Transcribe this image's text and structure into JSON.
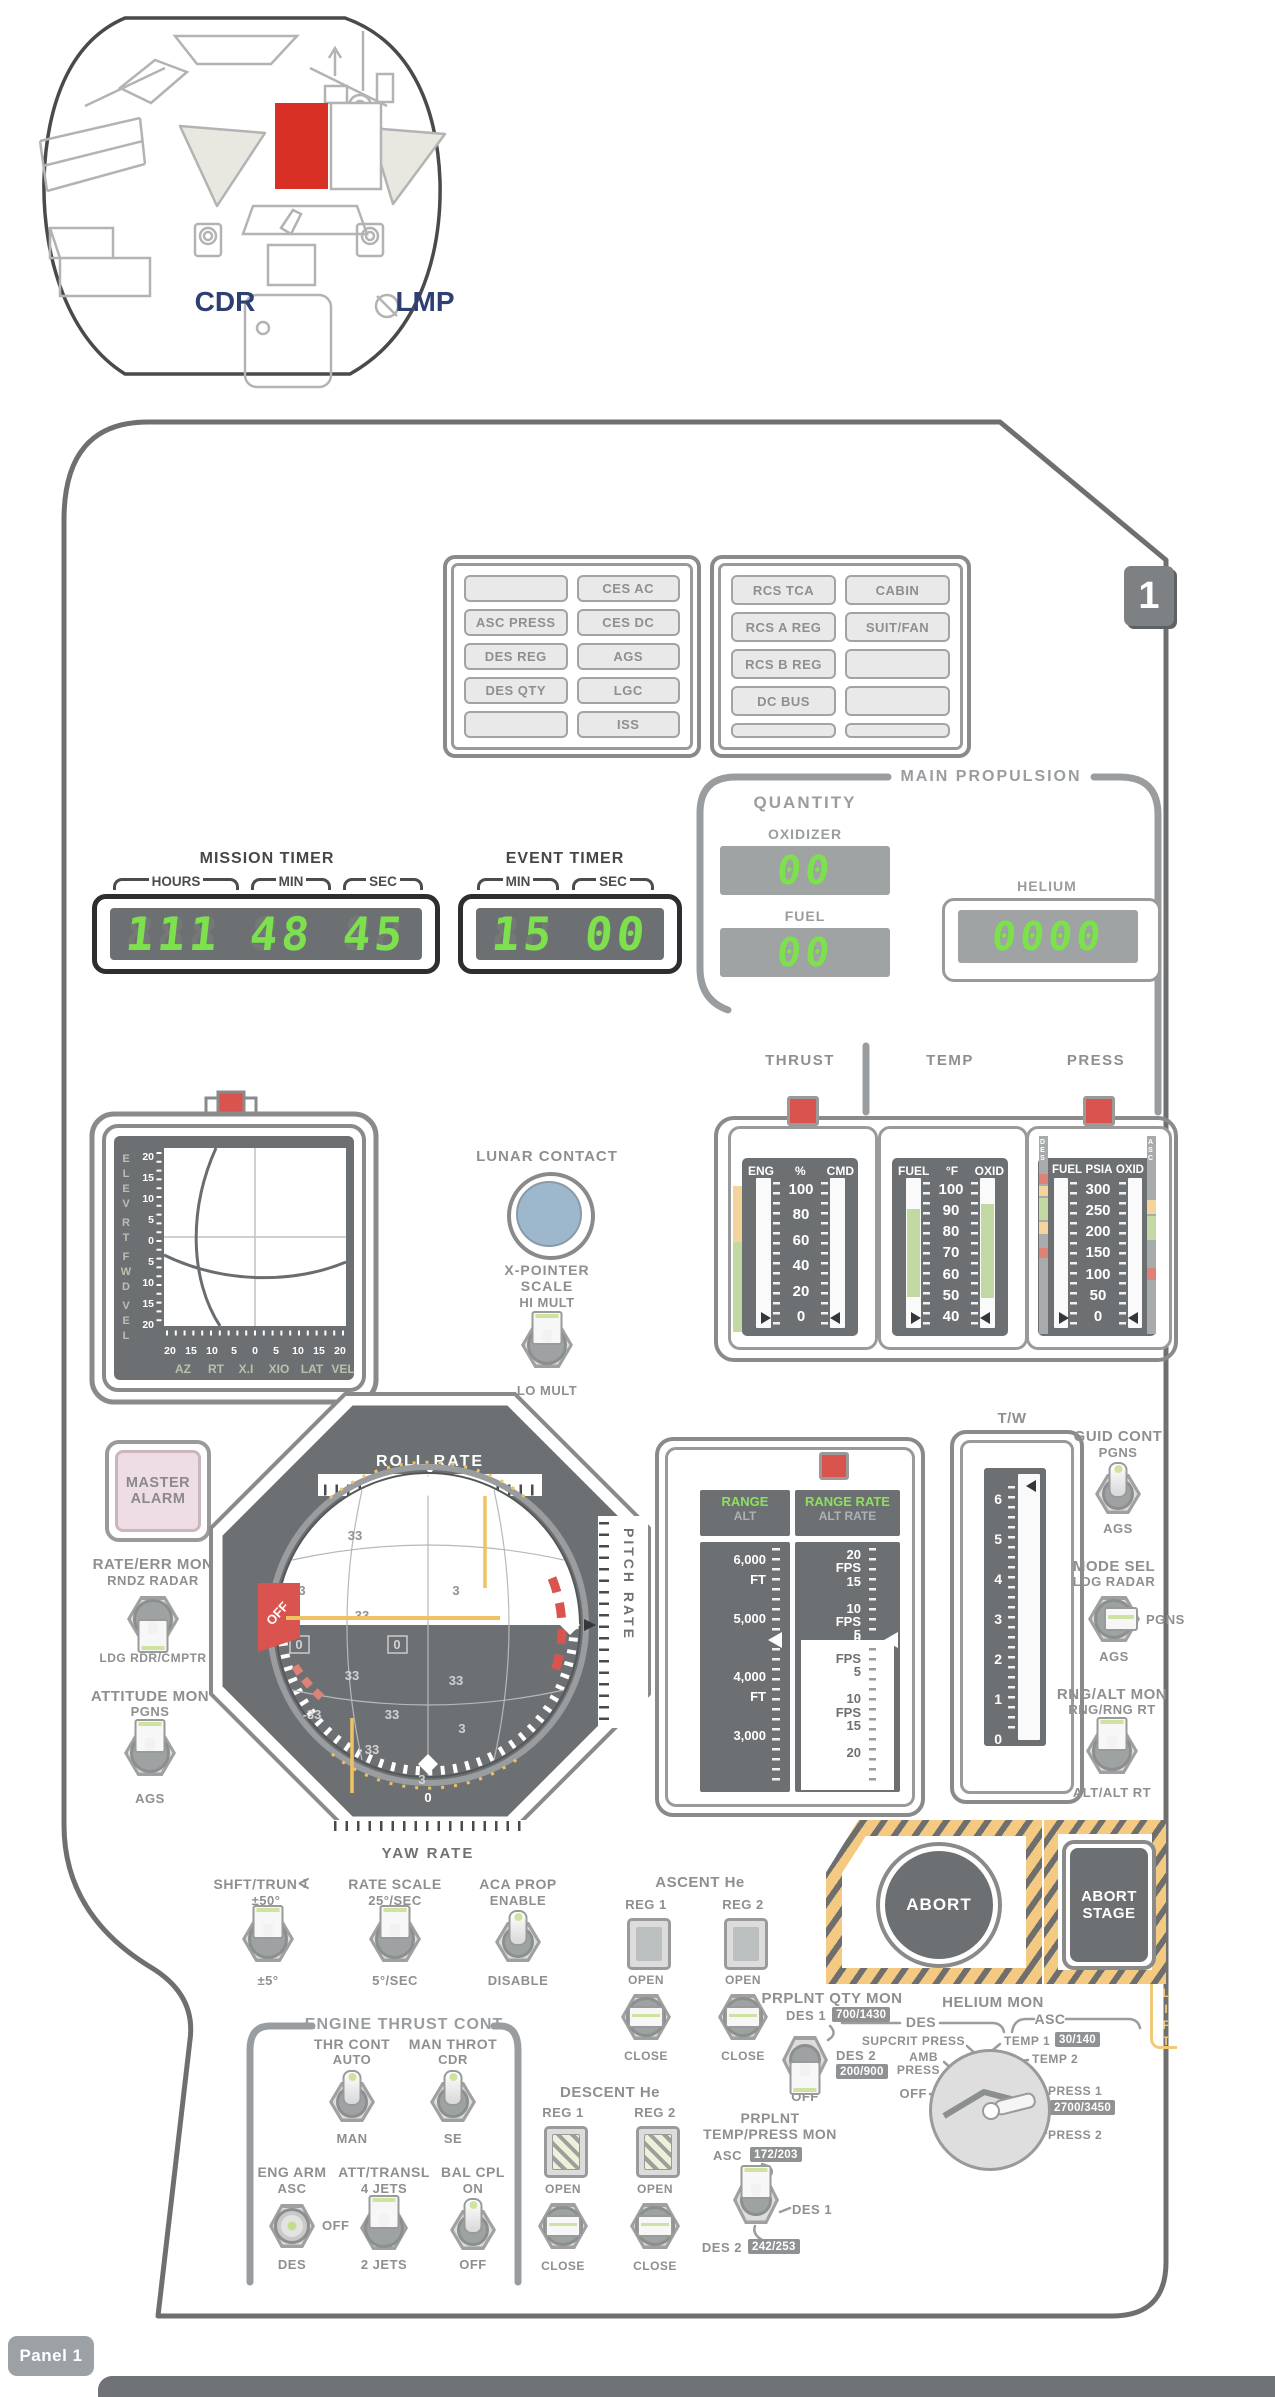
{
  "cabin": {
    "cdr": "CDR",
    "lmp": "LMP"
  },
  "panel_badge": "1",
  "cw_left": {
    "lights": [
      "",
      "CES AC",
      "ASC PRESS",
      "CES DC",
      "DES REG",
      "AGS",
      "DES QTY",
      "LGC",
      "",
      "ISS"
    ]
  },
  "cw_right": {
    "lights": [
      "RCS TCA",
      "CABIN",
      "RCS A REG",
      "SUIT/FAN",
      "RCS B REG",
      "",
      "DC BUS",
      "",
      "",
      ""
    ]
  },
  "mission_timer": {
    "title": "MISSION TIMER",
    "brackets": [
      "HOURS",
      "MIN",
      "SEC"
    ],
    "hours": "111",
    "min": "48",
    "sec": "45",
    "ghost3": "888",
    "ghost2": "88"
  },
  "event_timer": {
    "title": "EVENT TIMER",
    "brackets": [
      "MIN",
      "SEC"
    ],
    "min": "15",
    "sec": "00",
    "ghost2": "88"
  },
  "main_propulsion": {
    "title": "MAIN PROPULSION",
    "quantity": "QUANTITY",
    "oxidizer_label": "OXIDIZER",
    "oxidizer": "00",
    "fuel_label": "FUEL",
    "fuel": "00",
    "helium_label": "HELIUM",
    "helium": "0000",
    "ghost2": "88",
    "ghost4": "8888"
  },
  "thrust_gauge": {
    "title": "THRUST",
    "col_left": "ENG",
    "col_mid": "%",
    "col_right": "CMD",
    "scale": [
      "100",
      "80",
      "60",
      "40",
      "20",
      "0"
    ]
  },
  "temp_gauge": {
    "title": "TEMP",
    "col_left": "FUEL",
    "col_mid": "°F",
    "col_right": "OXID",
    "scale": [
      "100",
      "90",
      "80",
      "70",
      "60",
      "50",
      "40"
    ]
  },
  "press_gauge": {
    "title": "PRESS",
    "col_left": "FUEL",
    "col_mid": "PSIA",
    "col_right": "OXID",
    "scale": [
      "300",
      "250",
      "200",
      "150",
      "100",
      "50",
      "0"
    ],
    "left_strip": "DES",
    "right_strip": "ASC"
  },
  "xpointer": {
    "left_letters": [
      "E",
      "L",
      "E",
      "V",
      "R",
      "T",
      "F",
      "W",
      "D",
      "V",
      "E",
      "L"
    ],
    "v_scale": [
      "20",
      "15",
      "10",
      "5",
      "0",
      "5",
      "10",
      "15",
      "20"
    ],
    "h_scale": [
      "20",
      "15",
      "10",
      "5",
      "0",
      "5",
      "10",
      "15",
      "20"
    ],
    "bottom_labels": [
      "AZ",
      "RT",
      "X.I",
      "XIO",
      "LAT",
      "VEL"
    ]
  },
  "lunar_contact": {
    "label": "LUNAR CONTACT"
  },
  "xpointer_scale": {
    "title1": "X-POINTER",
    "title2": "SCALE",
    "up": "HI MULT",
    "down": "LO MULT"
  },
  "master_alarm": {
    "line1": "MASTER",
    "line2": "ALARM"
  },
  "rate_err_mon": {
    "title": "RATE/ERR MON",
    "up": "RNDZ RADAR",
    "down": "LDG RDR/CMPTR"
  },
  "attitude_mon": {
    "title": "ATTITUDE MON",
    "up": "PGNS",
    "down": "AGS"
  },
  "fdai": {
    "roll": "ROLL RATE",
    "pitch": "PITCH RATE",
    "yaw": "YAW RATE",
    "zero_top": "0",
    "zero_bottom": "0",
    "zero_pitch": "0",
    "off_flag": "OFF",
    "ball_numbers": [
      "33",
      "3",
      "3",
      "33",
      "0",
      "0",
      "33",
      "33",
      "-33",
      "33",
      "3",
      "33",
      "3"
    ]
  },
  "range_tapes": {
    "range": "RANGE",
    "alt": "ALT",
    "range_rate": "RANGE RATE",
    "alt_rate": "ALT RATE",
    "left_text": "6,000\nFT\n\n5,000\n\n\n4,000\nFT\n\n3,000",
    "right_top_text": "20\nFPS\n15\n\n10\nFPS\n5",
    "right_zero": "0",
    "right_bottom_text": "FPS\n5\n\n10\nFPS\n15\n\n20"
  },
  "tw_gauge": {
    "title": "T/W",
    "scale_text": "6\n5\n4\n3\n2\n1\n0"
  },
  "guid_cont": {
    "title": "GUID CONT",
    "up": "PGNS",
    "down": "AGS"
  },
  "mode_sel": {
    "title": "MODE SEL",
    "up": "LDG RADAR",
    "right": "PGNS",
    "down": "AGS"
  },
  "rng_alt_mon": {
    "title": "RNG/ALT MON",
    "up": "RNG/RNG RT",
    "down": "ALT/ALT RT"
  },
  "shft_trun": {
    "title": "SHFT/TRUN",
    "angle_icon": "∢",
    "up": "±50°",
    "down": "±5°"
  },
  "rate_scale": {
    "title": "RATE SCALE",
    "up": "25°/SEC",
    "down": "5°/SEC"
  },
  "aca_prop": {
    "title": "ACA PROP",
    "up": "ENABLE",
    "down": "DISABLE"
  },
  "ascent_he": {
    "title": "ASCENT He",
    "reg1": "REG 1",
    "reg2": "REG 2",
    "open": "OPEN",
    "close": "CLOSE"
  },
  "descent_he": {
    "title": "DESCENT He",
    "reg1": "REG 1",
    "reg2": "REG 2",
    "open": "OPEN",
    "close": "CLOSE"
  },
  "abort": {
    "abort": "ABORT",
    "stage_line1": "ABORT",
    "stage_line2": "STAGE",
    "lift": "LIFT"
  },
  "prplnt_qty_mon": {
    "title": "PRPLNT QTY MON",
    "des1": "DES 1",
    "des1_val": "700/1430",
    "des2": "DES 2",
    "des2_val": "200/900",
    "off": "OFF"
  },
  "helium_mon": {
    "title": "HELIUM MON",
    "des": "DES",
    "asc": "ASC",
    "supcrit": "SUPCRIT PRESS",
    "amb1": "AMB",
    "amb2": "PRESS",
    "off": "OFF",
    "temp1": "TEMP 1",
    "temp1_val": "30/140",
    "temp2": "TEMP 2",
    "press1": "PRESS 1",
    "press1_val": "2700/3450",
    "press2": "PRESS 2"
  },
  "engine_thrust_cont": {
    "title": "ENGINE THRUST CONT",
    "thr_cont": {
      "title": "THR CONT",
      "up": "AUTO",
      "down": "MAN"
    },
    "man_throt": {
      "title": "MAN THROT",
      "up": "CDR",
      "down": "SE"
    },
    "eng_arm": {
      "title": "ENG ARM",
      "up": "ASC",
      "mid": "OFF",
      "down": "DES"
    },
    "att_transl": {
      "title": "ATT/TRANSL",
      "up": "4 JETS",
      "down": "2 JETS"
    },
    "bal_cpl": {
      "title": "BAL CPL",
      "up": "ON",
      "down": "OFF"
    }
  },
  "prplnt_temp_mon": {
    "title1": "PRPLNT",
    "title2": "TEMP/PRESS MON",
    "asc": "ASC",
    "asc_val": "172/203",
    "des1": "DES 1",
    "des2": "DES 2",
    "des2_val": "242/253"
  },
  "footer": {
    "label": "Panel 1"
  },
  "colors": {
    "accent_red": "#d93025",
    "lamp_red": "#d9534f",
    "digit_green": "#7de14e",
    "lunar_blue": "#9db8cd",
    "hazard_yellow": "#f2c879",
    "band_green": "#c3d9a4",
    "band_orange": "#f2d49c",
    "band_red": "#dc8277",
    "panel_gray": "#6d7072",
    "label_navy": "#2e3f71"
  }
}
